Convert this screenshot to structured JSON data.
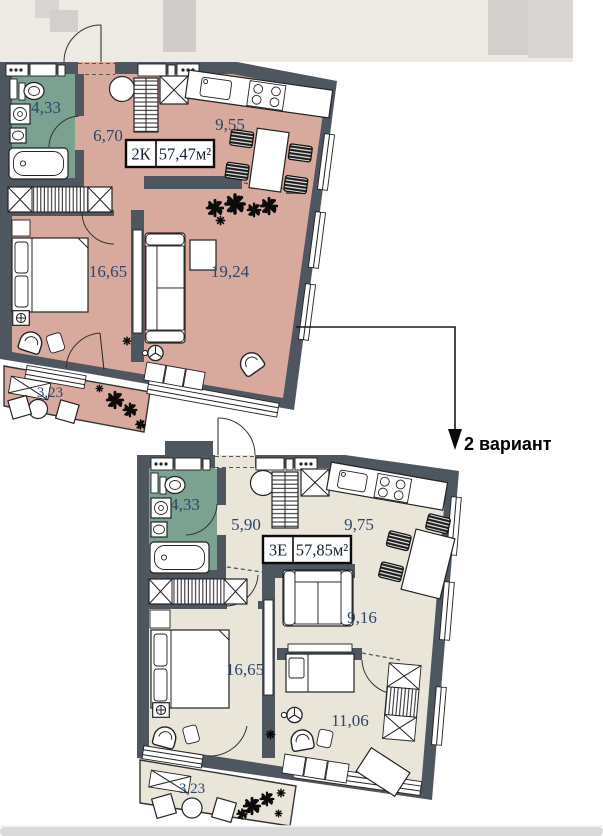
{
  "annotation": {
    "variant_label": "2 вариант"
  },
  "plans": [
    {
      "name": "plan-1",
      "badge": {
        "rooms_type": "2К",
        "total_area": "57,47м²"
      },
      "room_areas": {
        "bathroom": "4,33",
        "hallway": "6,70",
        "kitchen": "9,55",
        "bedroom": "16,65",
        "living_room": "19,24",
        "balcony": "3,23"
      }
    },
    {
      "name": "plan-2",
      "badge": {
        "rooms_type": "3Е",
        "total_area": "57,85м²"
      },
      "room_areas": {
        "bathroom": "4,33",
        "hallway": "5,90",
        "kitchen": "9,75",
        "living_room": "9,16",
        "bedroom": "16,65",
        "kids_room": "11,06",
        "balcony": "3,23"
      }
    }
  ],
  "icons": {
    "plant": "plant-cluster",
    "variant_arrow": "down-arrow"
  },
  "colors": {
    "wall": "#4e575f",
    "floorA": "#d8aa9d",
    "floorB": "#eae5d9",
    "bath": "#7ba291",
    "corridor": "#edeae4",
    "labelText": "#2d4569",
    "badgeText": "#14202e",
    "annotText": "#000000",
    "bar": "#dadada"
  }
}
